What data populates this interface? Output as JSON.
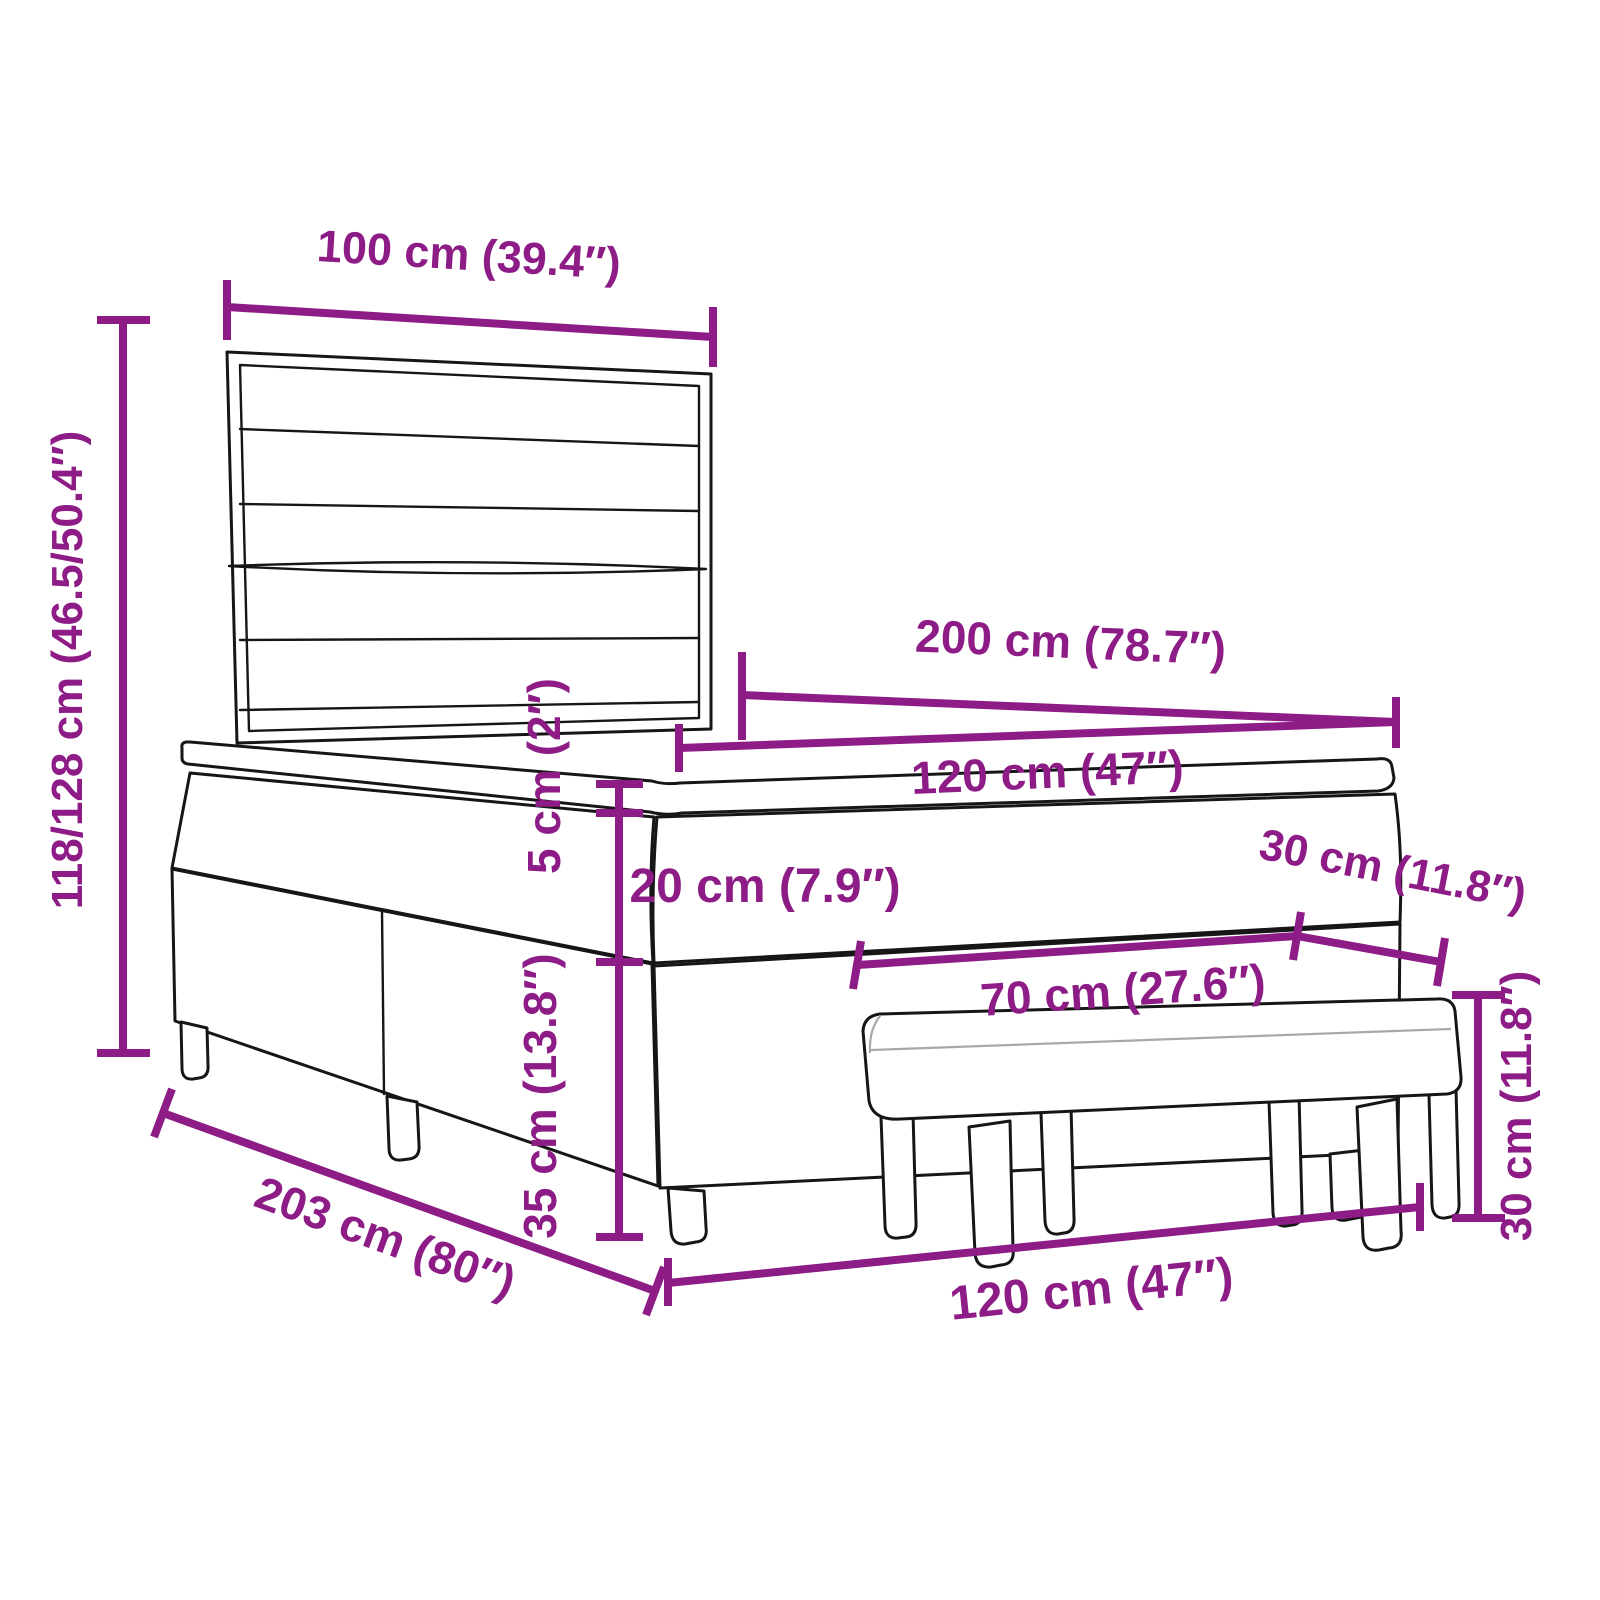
{
  "diagram": {
    "subject": "Box spring bed with striped headboard, mattress topper and upholstered bench – dimension drawing",
    "accent_color": "#8D1C86",
    "line_color": "#161616",
    "background_color": "#ffffff",
    "unit_system": "cm (inches)"
  },
  "dimensions": {
    "headboard_width": "100 cm (39.4″)",
    "total_height": "118/128 cm (46.5/50.4″)",
    "mattress_length": "200 cm (78.7″)",
    "mattress_width": "120 cm (47″)",
    "topper_height": "5 cm (2″)",
    "mattress_height": "20 cm (7.9″)",
    "bench_depth": "30 cm (11.8″)",
    "bench_length": "70 cm (27.6″)",
    "frame_length": "203 cm (80″)",
    "frame_width": "120 cm (47″)",
    "frame_height": "35 cm (13.8″)",
    "bench_height": "30 cm (11.8″)"
  }
}
